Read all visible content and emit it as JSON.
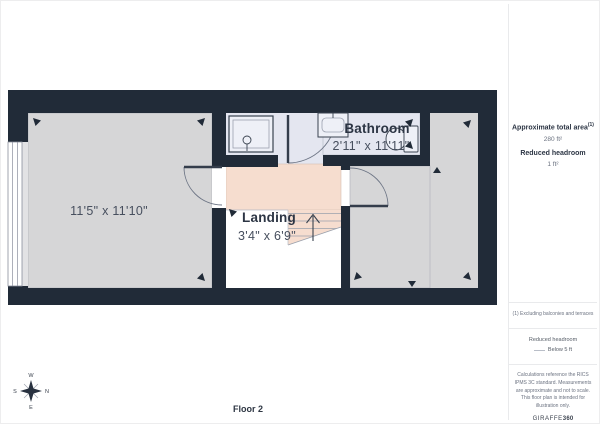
{
  "plan": {
    "floor_label": "Floor 2",
    "room_left_dims": "11'5\" x 11'10\"",
    "bathroom_name": "Bathroom",
    "bathroom_dims": "2'11\" x 11'11\"",
    "landing_name": "Landing",
    "landing_dims": "3'4\" x 6'9\"",
    "compass": {
      "w": "W",
      "s": "S",
      "n": "N",
      "e": "E"
    }
  },
  "sidebar": {
    "total_area_label": "Approximate total area",
    "total_area_note_marker": "(1)",
    "total_area_value": "280 ft²",
    "reduced_headroom_label": "Reduced headroom",
    "reduced_headroom_value": "1 ft²",
    "footnote": "(1) Excluding balconies and terraces",
    "legend_title": "Reduced headroom",
    "legend_item": "Below 5 ft",
    "disclaimer": "Calculations reference the RICS IPMS 3C standard. Measurements are approximate and not to scale. This floor plan is intended for illustration only.",
    "brand_light": "GIRAFFE",
    "brand_bold": "360"
  },
  "colors": {
    "wall": "#212b38",
    "room_fill": "#d6d6d7",
    "bathroom_fill": "#e4e6f0",
    "landing_fill": "#f6ddcf",
    "fixture_fill": "#eef0f7",
    "outline": "#9aa0ac",
    "label_text": "#474f5e",
    "heading_text": "#2c3544",
    "muted_text": "#6b7280"
  }
}
